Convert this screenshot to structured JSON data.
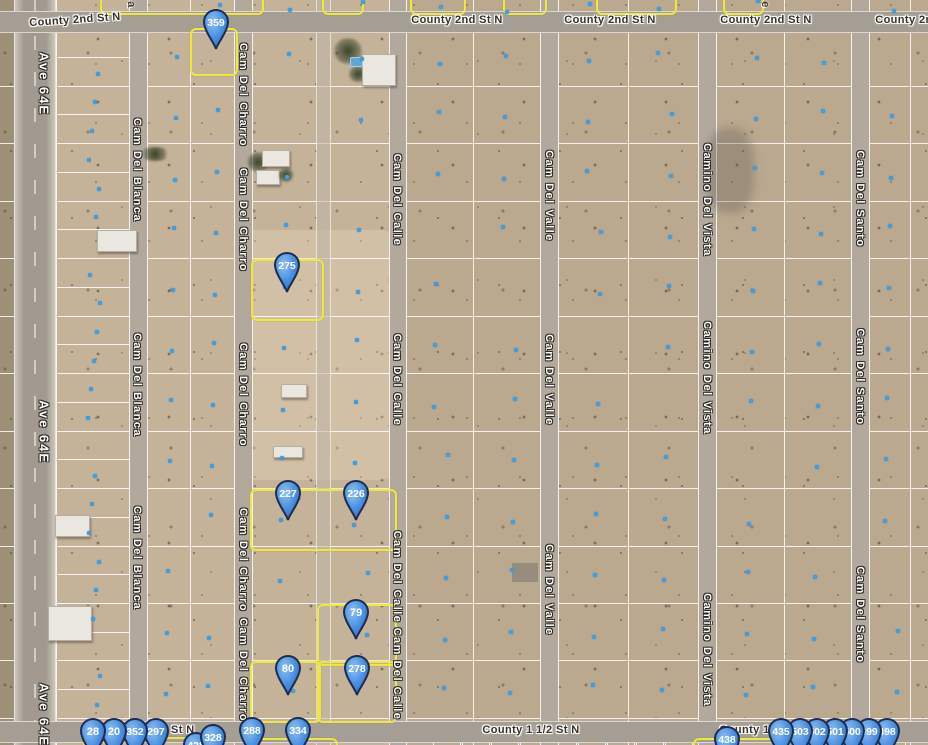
{
  "map": {
    "kind": "satellite-parcel-map",
    "colors": {
      "desert_base": "#c5b399",
      "parcel_line": "#ffffff",
      "highlight_yellow": "#efe73c",
      "parcel_dot_blue": "#3f9fe0",
      "pin_fill": "#4a90e2",
      "pin_stroke": "#1d2c4e",
      "pin_text": "#ffffff",
      "road_paved": "#a29a90",
      "road_dirt": "#b2a99c"
    }
  },
  "streets": {
    "horizontal": [
      {
        "name": "County 2nd St N",
        "y": 20,
        "instances": [
          {
            "x": 75,
            "rot": -4
          },
          {
            "x": 457,
            "rot": 0
          },
          {
            "x": 610,
            "rot": 0
          },
          {
            "x": 766,
            "rot": 0
          },
          {
            "x": 921,
            "rot": 0
          }
        ]
      },
      {
        "name": "County 1 1/2 St N",
        "y": 730,
        "instances": [
          {
            "x": 146,
            "rot": 0
          },
          {
            "x": 531,
            "rot": 0
          },
          {
            "x": 768,
            "rot": 0
          }
        ]
      }
    ],
    "vertical": [
      {
        "name": "Ave 64E",
        "x": 44,
        "big": true,
        "labels_y": [
          84,
          432,
          715
        ]
      },
      {
        "name": "Cam Del Blanca",
        "x": 137,
        "labels_y": [
          170,
          385,
          558
        ]
      },
      {
        "name": "Cam Del Charro",
        "x": 243,
        "labels_y": [
          95,
          220,
          395,
          560,
          670
        ]
      },
      {
        "name": "Cam Del Calle",
        "x": 397,
        "labels_y": [
          200,
          380,
          577,
          674
        ]
      },
      {
        "name": "Cam Del Valle",
        "x": 549,
        "labels_y": [
          196,
          380,
          590
        ]
      },
      {
        "name": "Camino Del Vista",
        "x": 707,
        "labels_y": [
          200,
          378,
          650
        ]
      },
      {
        "name": "Cam Del Santo",
        "x": 860,
        "labels_y": [
          199,
          377,
          615
        ]
      }
    ],
    "fragments": [
      {
        "text": "a",
        "x": 131,
        "y": 5
      },
      {
        "text": "e",
        "x": 765,
        "y": 5
      }
    ]
  },
  "pins": [
    {
      "label": "359",
      "x": 216,
      "y": 22
    },
    {
      "label": "275",
      "x": 287,
      "y": 265
    },
    {
      "label": "227",
      "x": 288,
      "y": 493
    },
    {
      "label": "226",
      "x": 356,
      "y": 493
    },
    {
      "label": "79",
      "x": 356,
      "y": 612
    },
    {
      "label": "80",
      "x": 288,
      "y": 668
    },
    {
      "label": "278",
      "x": 357,
      "y": 668
    },
    {
      "label": "428",
      "x": 196,
      "y": 745
    },
    {
      "label": "328",
      "x": 213,
      "y": 737
    },
    {
      "label": "297",
      "x": 156,
      "y": 731
    },
    {
      "label": "352",
      "x": 135,
      "y": 731
    },
    {
      "label": "20",
      "x": 114,
      "y": 731
    },
    {
      "label": "28",
      "x": 93,
      "y": 731
    },
    {
      "label": "288",
      "x": 252,
      "y": 730
    },
    {
      "label": "334",
      "x": 298,
      "y": 730
    },
    {
      "label": "438",
      "x": 727,
      "y": 739
    },
    {
      "label": "498",
      "x": 887,
      "y": 731
    },
    {
      "label": "499",
      "x": 869,
      "y": 731
    },
    {
      "label": "500",
      "x": 852,
      "y": 731
    },
    {
      "label": "501",
      "x": 835,
      "y": 731
    },
    {
      "label": "502",
      "x": 817,
      "y": 731
    },
    {
      "label": "503",
      "x": 800,
      "y": 731
    },
    {
      "label": "435",
      "x": 781,
      "y": 731
    }
  ],
  "highlighted_parcels": [
    {
      "x": 190,
      "y": 28,
      "w": 44,
      "h": 44
    },
    {
      "x": 251,
      "y": 259,
      "w": 69,
      "h": 58
    },
    {
      "x": 250,
      "y": 489,
      "w": 143,
      "h": 58
    },
    {
      "x": 317,
      "y": 604,
      "w": 76,
      "h": 58
    },
    {
      "x": 250,
      "y": 661,
      "w": 67,
      "h": 58
    },
    {
      "x": 317,
      "y": 661,
      "w": 76,
      "h": 58
    },
    {
      "x": 100,
      "y": -30,
      "w": 160,
      "h": 41
    },
    {
      "x": 322,
      "y": -30,
      "w": 38,
      "h": 41
    },
    {
      "x": 410,
      "y": -30,
      "w": 52,
      "h": 41
    },
    {
      "x": 503,
      "y": -30,
      "w": 40,
      "h": 41
    },
    {
      "x": 596,
      "y": -30,
      "w": 77,
      "h": 41
    },
    {
      "x": 723,
      "y": -30,
      "w": 37,
      "h": 41
    },
    {
      "x": 83,
      "y": 737,
      "w": 104,
      "h": 30
    },
    {
      "x": 248,
      "y": 738,
      "w": 86,
      "h": 30
    },
    {
      "x": 693,
      "y": 738,
      "w": 84,
      "h": 30
    }
  ],
  "features": [
    {
      "kind": "trees",
      "x": 333,
      "y": 38,
      "w": 30,
      "h": 26
    },
    {
      "kind": "trees",
      "x": 348,
      "y": 66,
      "w": 20,
      "h": 16
    },
    {
      "kind": "building",
      "x": 362,
      "y": 54,
      "w": 32,
      "h": 30
    },
    {
      "kind": "pool",
      "x": 350,
      "y": 57,
      "w": 11,
      "h": 8
    },
    {
      "kind": "trees",
      "x": 247,
      "y": 152,
      "w": 22,
      "h": 20
    },
    {
      "kind": "building",
      "x": 262,
      "y": 150,
      "w": 26,
      "h": 15
    },
    {
      "kind": "building",
      "x": 256,
      "y": 170,
      "w": 22,
      "h": 13
    },
    {
      "kind": "trees",
      "x": 278,
      "y": 168,
      "w": 16,
      "h": 14
    },
    {
      "kind": "trees",
      "x": 140,
      "y": 147,
      "w": 30,
      "h": 14
    },
    {
      "kind": "building",
      "x": 281,
      "y": 384,
      "w": 24,
      "h": 12
    },
    {
      "kind": "building",
      "x": 273,
      "y": 446,
      "w": 28,
      "h": 10
    },
    {
      "kind": "building",
      "x": 55,
      "y": 515,
      "w": 33,
      "h": 20
    },
    {
      "kind": "building",
      "x": 48,
      "y": 606,
      "w": 42,
      "h": 33
    },
    {
      "kind": "building",
      "x": 97,
      "y": 230,
      "w": 38,
      "h": 20
    },
    {
      "kind": "pad",
      "x": 512,
      "y": 563,
      "w": 26,
      "h": 19
    },
    {
      "kind": "smudge",
      "x": 706,
      "y": 128,
      "w": 48,
      "h": 85
    }
  ]
}
